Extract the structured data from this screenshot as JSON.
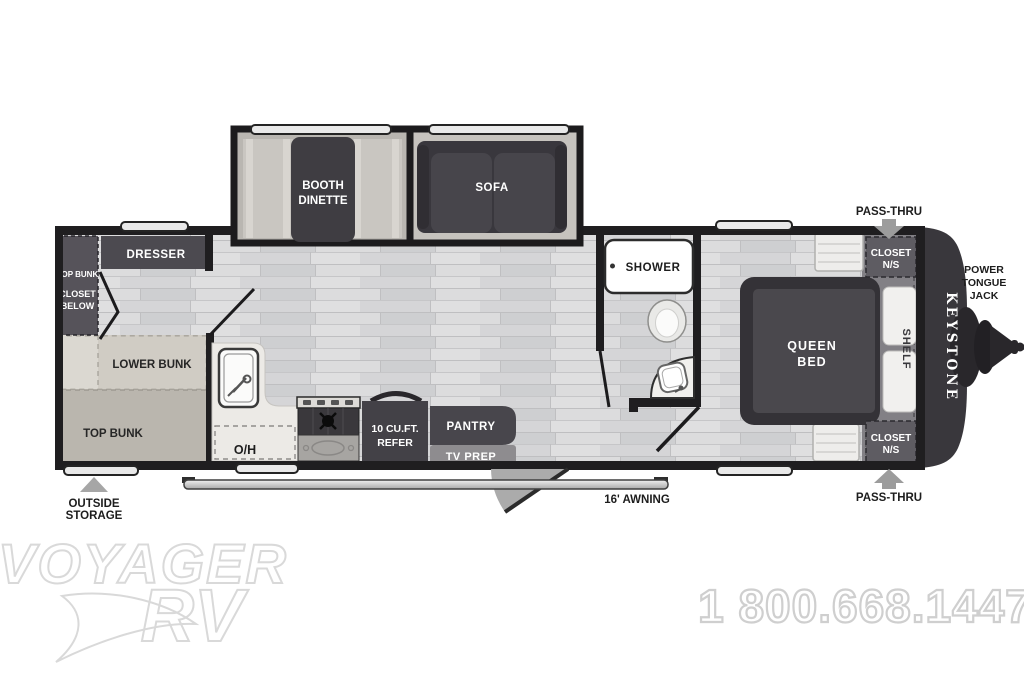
{
  "watermark": {
    "logo_top": "VOYAGER",
    "logo_bottom": "RV",
    "phone": "1 800.668.1447"
  },
  "exterior": {
    "brand_vertical": "KEYSTONE",
    "pass_thru_top": "PASS-THRU",
    "pass_thru_bottom": "PASS-THRU",
    "power_tongue_jack": [
      "POWER",
      "TONGUE",
      "JACK"
    ],
    "outside_storage": [
      "OUTSIDE",
      "STORAGE"
    ],
    "awning_label": "16' AWNING"
  },
  "rooms": {
    "booth_dinette": [
      "BOOTH",
      "DINETTE"
    ],
    "sofa": "SOFA",
    "dresser": "DRESSER",
    "bunk_closet": [
      "TOP BUNK",
      "CLOSET",
      "BELOW"
    ],
    "lower_bunk": "LOWER BUNK",
    "top_bunk": "TOP BUNK",
    "overhead": "O/H",
    "refer": [
      "10 CU.FT.",
      "REFER"
    ],
    "pantry": "PANTRY",
    "tv_prep": "TV PREP",
    "shower": "SHOWER",
    "queen_bed": [
      "QUEEN",
      "BED"
    ],
    "shelf": "SHELF",
    "closet_ns_front_top": [
      "CLOSET",
      "N/S"
    ],
    "closet_ns_front_bottom": [
      "CLOSET",
      "N/S"
    ]
  },
  "colors": {
    "wall": "#1f1e20",
    "floor_base": "#d9d9da",
    "furniture_dark": "#454349",
    "bench_light": "#c9c6c1",
    "bunk_warm_gray": "#bab6ae",
    "platform_gray": "#828085",
    "arrow_gray": "#9c9c9c",
    "watermark_gray": "#d9d9d9"
  }
}
